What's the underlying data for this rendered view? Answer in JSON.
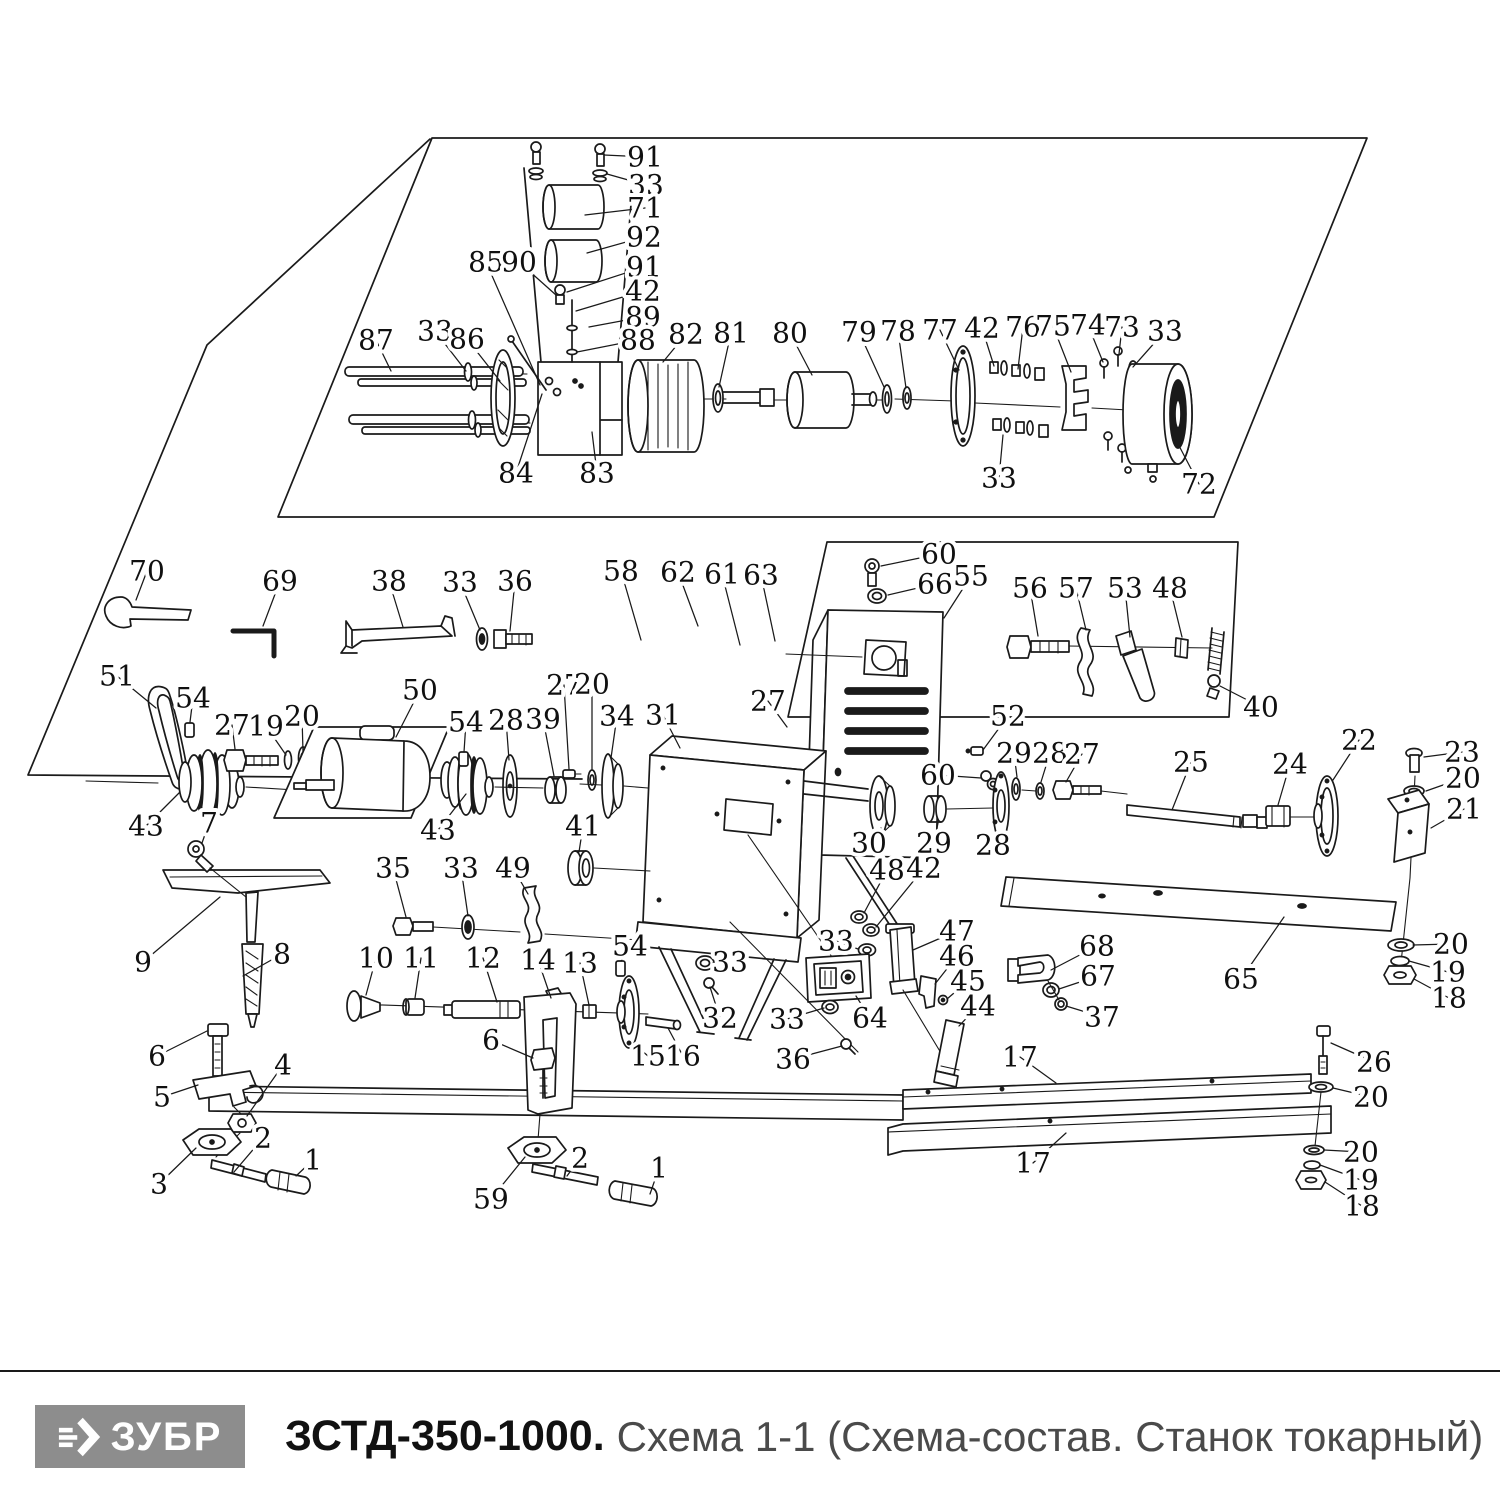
{
  "footer": {
    "logo_text": "ЗУБР",
    "title_model": "ЗСТД-350-1000.",
    "title_rest": "Схема 1-1 (Схема-состав. Станок токарный)",
    "colors": {
      "logo_bg": "#8d8d8d",
      "logo_fg": "#ffffff",
      "title_model_color": "#111111",
      "title_rest_color": "#4a4a4a",
      "rule_color": "#1a1a1a"
    }
  },
  "diagram": {
    "ink": "#1a1a1a",
    "labels": [
      {
        "n": "91",
        "x": 645,
        "y": 157,
        "lx": 604,
        "ly": 155
      },
      {
        "n": "33",
        "x": 646,
        "y": 185,
        "lx": 607,
        "ly": 174
      },
      {
        "n": "71",
        "x": 645,
        "y": 208,
        "lx": 585,
        "ly": 215
      },
      {
        "n": "92",
        "x": 644,
        "y": 237,
        "lx": 587,
        "ly": 253
      },
      {
        "n": "91",
        "x": 644,
        "y": 267,
        "lx": 567,
        "ly": 292
      },
      {
        "n": "42",
        "x": 643,
        "y": 291,
        "lx": 576,
        "ly": 311
      },
      {
        "n": "89",
        "x": 643,
        "y": 317,
        "lx": 589,
        "ly": 327
      },
      {
        "n": "88",
        "x": 638,
        "y": 340,
        "lx": 577,
        "ly": 352
      },
      {
        "n": "85",
        "x": 486,
        "y": 262,
        "lx": 540,
        "ly": 385
      },
      {
        "n": "90",
        "x": 519,
        "y": 262,
        "lx": 556,
        "ly": 295
      },
      {
        "n": "87",
        "x": 376,
        "y": 340,
        "lx": 391,
        "ly": 371
      },
      {
        "n": "33",
        "x": 435,
        "y": 331,
        "lx": 466,
        "ly": 371
      },
      {
        "n": "86",
        "x": 467,
        "y": 339,
        "lx": 500,
        "ly": 381
      },
      {
        "n": "82",
        "x": 686,
        "y": 334,
        "lx": 663,
        "ly": 362
      },
      {
        "n": "81",
        "x": 731,
        "y": 333,
        "lx": 719,
        "ly": 387
      },
      {
        "n": "80",
        "x": 790,
        "y": 333,
        "lx": 812,
        "ly": 375
      },
      {
        "n": "79",
        "x": 859,
        "y": 332,
        "lx": 884,
        "ly": 387
      },
      {
        "n": "78",
        "x": 898,
        "y": 331,
        "lx": 906,
        "ly": 388
      },
      {
        "n": "77",
        "x": 940,
        "y": 330,
        "lx": 959,
        "ly": 370
      },
      {
        "n": "42",
        "x": 982,
        "y": 328,
        "lx": 994,
        "ly": 366
      },
      {
        "n": "76",
        "x": 1023,
        "y": 327,
        "lx": 1018,
        "ly": 369
      },
      {
        "n": "75",
        "x": 1053,
        "y": 326,
        "lx": 1071,
        "ly": 372
      },
      {
        "n": "74",
        "x": 1088,
        "y": 325,
        "lx": 1103,
        "ly": 362
      },
      {
        "n": "73",
        "x": 1122,
        "y": 327,
        "lx": 1119,
        "ly": 354
      },
      {
        "n": "33",
        "x": 1165,
        "y": 331,
        "lx": 1133,
        "ly": 367
      },
      {
        "n": "84",
        "x": 516,
        "y": 473,
        "lx": 542,
        "ly": 394
      },
      {
        "n": "83",
        "x": 597,
        "y": 473,
        "lx": 592,
        "ly": 432
      },
      {
        "n": "33",
        "x": 999,
        "y": 478,
        "lx": 1003,
        "ly": 435
      },
      {
        "n": "72",
        "x": 1199,
        "y": 484,
        "lx": 1176,
        "ly": 440
      },
      {
        "n": "70",
        "x": 147,
        "y": 571,
        "lx": 136,
        "ly": 600
      },
      {
        "n": "69",
        "x": 280,
        "y": 581,
        "lx": 263,
        "ly": 626
      },
      {
        "n": "38",
        "x": 389,
        "y": 581,
        "lx": 403,
        "ly": 627
      },
      {
        "n": "33",
        "x": 460,
        "y": 582,
        "lx": 480,
        "ly": 630
      },
      {
        "n": "36",
        "x": 515,
        "y": 581,
        "lx": 510,
        "ly": 631
      },
      {
        "n": "58",
        "x": 621,
        "y": 571,
        "lx": 641,
        "ly": 640
      },
      {
        "n": "62",
        "x": 678,
        "y": 572,
        "lx": 698,
        "ly": 626
      },
      {
        "n": "61",
        "x": 722,
        "y": 574,
        "lx": 740,
        "ly": 645
      },
      {
        "n": "63",
        "x": 761,
        "y": 575,
        "lx": 775,
        "ly": 641
      },
      {
        "n": "60",
        "x": 939,
        "y": 554,
        "lx": 881,
        "ly": 566
      },
      {
        "n": "66",
        "x": 935,
        "y": 584,
        "lx": 888,
        "ly": 595
      },
      {
        "n": "55",
        "x": 971,
        "y": 576,
        "lx": 944,
        "ly": 618
      },
      {
        "n": "56",
        "x": 1030,
        "y": 588,
        "lx": 1038,
        "ly": 636
      },
      {
        "n": "57",
        "x": 1076,
        "y": 588,
        "lx": 1086,
        "ly": 630
      },
      {
        "n": "53",
        "x": 1125,
        "y": 588,
        "lx": 1130,
        "ly": 637
      },
      {
        "n": "48",
        "x": 1170,
        "y": 588,
        "lx": 1182,
        "ly": 637
      },
      {
        "n": "40",
        "x": 1261,
        "y": 707,
        "lx": 1220,
        "ly": 686
      },
      {
        "n": "51",
        "x": 117,
        "y": 676,
        "lx": 156,
        "ly": 708
      },
      {
        "n": "54",
        "x": 193,
        "y": 698,
        "lx": 190,
        "ly": 722
      },
      {
        "n": "27",
        "x": 232,
        "y": 725,
        "lx": 235,
        "ly": 749
      },
      {
        "n": "19",
        "x": 266,
        "y": 726,
        "lx": 286,
        "ly": 755
      },
      {
        "n": "20",
        "x": 302,
        "y": 716,
        "lx": 303,
        "ly": 752
      },
      {
        "n": "50",
        "x": 420,
        "y": 690,
        "lx": 396,
        "ly": 737
      },
      {
        "n": "54",
        "x": 466,
        "y": 722,
        "lx": 464,
        "ly": 752
      },
      {
        "n": "28",
        "x": 506,
        "y": 720,
        "lx": 509,
        "ly": 760
      },
      {
        "n": "39",
        "x": 543,
        "y": 719,
        "lx": 554,
        "ly": 776
      },
      {
        "n": "27",
        "x": 564,
        "y": 685,
        "lx": 569,
        "ly": 769
      },
      {
        "n": "20",
        "x": 592,
        "y": 684,
        "lx": 592,
        "ly": 769
      },
      {
        "n": "34",
        "x": 617,
        "y": 716,
        "lx": 611,
        "ly": 758
      },
      {
        "n": "31",
        "x": 663,
        "y": 715,
        "lx": 680,
        "ly": 748
      },
      {
        "n": "27",
        "x": 768,
        "y": 701,
        "lx": 787,
        "ly": 727
      },
      {
        "n": "52",
        "x": 1008,
        "y": 716,
        "lx": 983,
        "ly": 750
      },
      {
        "n": "29",
        "x": 1014,
        "y": 753,
        "lx": 1017,
        "ly": 777
      },
      {
        "n": "28",
        "x": 1050,
        "y": 753,
        "lx": 1041,
        "ly": 782
      },
      {
        "n": "27",
        "x": 1082,
        "y": 754,
        "lx": 1066,
        "ly": 782
      },
      {
        "n": "25",
        "x": 1191,
        "y": 762,
        "lx": 1172,
        "ly": 810
      },
      {
        "n": "24",
        "x": 1290,
        "y": 764,
        "lx": 1278,
        "ly": 805
      },
      {
        "n": "22",
        "x": 1359,
        "y": 740,
        "lx": 1333,
        "ly": 780
      },
      {
        "n": "23",
        "x": 1462,
        "y": 752,
        "lx": 1424,
        "ly": 757
      },
      {
        "n": "20",
        "x": 1463,
        "y": 778,
        "lx": 1426,
        "ly": 791
      },
      {
        "n": "21",
        "x": 1464,
        "y": 809,
        "lx": 1431,
        "ly": 828
      },
      {
        "n": "30",
        "x": 869,
        "y": 843,
        "lx": 881,
        "ly": 828
      },
      {
        "n": "29",
        "x": 934,
        "y": 843,
        "lx": 938,
        "ly": 823
      },
      {
        "n": "28",
        "x": 993,
        "y": 845,
        "lx": 1001,
        "ly": 832
      },
      {
        "n": "60",
        "x": 938,
        "y": 775,
        "lx": 981,
        "ly": 778
      },
      {
        "n": "48",
        "x": 887,
        "y": 870,
        "lx": 864,
        "ly": 913
      },
      {
        "n": "42",
        "x": 924,
        "y": 868,
        "lx": 876,
        "ly": 927
      },
      {
        "n": "33",
        "x": 836,
        "y": 941,
        "lx": 858,
        "ly": 949
      },
      {
        "n": "47",
        "x": 957,
        "y": 931,
        "lx": 913,
        "ly": 950
      },
      {
        "n": "46",
        "x": 957,
        "y": 956,
        "lx": 935,
        "ly": 984
      },
      {
        "n": "45",
        "x": 968,
        "y": 981,
        "lx": 947,
        "ly": 999
      },
      {
        "n": "44",
        "x": 978,
        "y": 1006,
        "lx": 959,
        "ly": 1026
      },
      {
        "n": "68",
        "x": 1097,
        "y": 946,
        "lx": 1051,
        "ly": 970
      },
      {
        "n": "67",
        "x": 1098,
        "y": 976,
        "lx": 1059,
        "ly": 989
      },
      {
        "n": "37",
        "x": 1102,
        "y": 1017,
        "lx": 1066,
        "ly": 1006
      },
      {
        "n": "65",
        "x": 1241,
        "y": 979,
        "lx": 1284,
        "ly": 917
      },
      {
        "n": "20",
        "x": 1451,
        "y": 944,
        "lx": 1413,
        "ly": 945
      },
      {
        "n": "19",
        "x": 1448,
        "y": 972,
        "lx": 1409,
        "ly": 961
      },
      {
        "n": "18",
        "x": 1449,
        "y": 998,
        "lx": 1414,
        "ly": 979
      },
      {
        "n": "17",
        "x": 1020,
        "y": 1057,
        "lx": 1056,
        "ly": 1083
      },
      {
        "n": "26",
        "x": 1374,
        "y": 1062,
        "lx": 1331,
        "ly": 1043
      },
      {
        "n": "20",
        "x": 1371,
        "y": 1097,
        "lx": 1333,
        "ly": 1088
      },
      {
        "n": "17",
        "x": 1033,
        "y": 1163,
        "lx": 1066,
        "ly": 1133
      },
      {
        "n": "20",
        "x": 1361,
        "y": 1152,
        "lx": 1324,
        "ly": 1150
      },
      {
        "n": "19",
        "x": 1361,
        "y": 1180,
        "lx": 1320,
        "ly": 1165
      },
      {
        "n": "18",
        "x": 1362,
        "y": 1206,
        "lx": 1325,
        "ly": 1182
      },
      {
        "n": "9",
        "x": 143,
        "y": 962,
        "lx": 220,
        "ly": 897
      },
      {
        "n": "8",
        "x": 282,
        "y": 954,
        "lx": 243,
        "ly": 976
      },
      {
        "n": "35",
        "x": 393,
        "y": 868,
        "lx": 406,
        "ly": 917
      },
      {
        "n": "33",
        "x": 461,
        "y": 868,
        "lx": 468,
        "ly": 916
      },
      {
        "n": "49",
        "x": 513,
        "y": 868,
        "lx": 528,
        "ly": 894
      },
      {
        "n": "10",
        "x": 376,
        "y": 958,
        "lx": 366,
        "ly": 995
      },
      {
        "n": "11",
        "x": 421,
        "y": 958,
        "lx": 415,
        "ly": 998
      },
      {
        "n": "12",
        "x": 483,
        "y": 958,
        "lx": 497,
        "ly": 1002
      },
      {
        "n": "14",
        "x": 538,
        "y": 960,
        "lx": 551,
        "ly": 998
      },
      {
        "n": "13",
        "x": 580,
        "y": 963,
        "lx": 589,
        "ly": 1005
      },
      {
        "n": "54",
        "x": 630,
        "y": 946,
        "lx": 621,
        "ly": 961
      },
      {
        "n": "6",
        "x": 157,
        "y": 1056,
        "lx": 207,
        "ly": 1031
      },
      {
        "n": "5",
        "x": 162,
        "y": 1097,
        "lx": 198,
        "ly": 1085
      },
      {
        "n": "4",
        "x": 283,
        "y": 1065,
        "lx": 247,
        "ly": 1116
      },
      {
        "n": "2",
        "x": 263,
        "y": 1138,
        "lx": 234,
        "ly": 1172
      },
      {
        "n": "1",
        "x": 313,
        "y": 1160,
        "lx": 296,
        "ly": 1176
      },
      {
        "n": "3",
        "x": 159,
        "y": 1184,
        "lx": 196,
        "ly": 1148
      },
      {
        "n": "6",
        "x": 491,
        "y": 1040,
        "lx": 533,
        "ly": 1058
      },
      {
        "n": "59",
        "x": 491,
        "y": 1199,
        "lx": 525,
        "ly": 1157
      },
      {
        "n": "2",
        "x": 580,
        "y": 1158,
        "lx": 567,
        "ly": 1176
      },
      {
        "n": "1",
        "x": 659,
        "y": 1168,
        "lx": 650,
        "ly": 1194
      },
      {
        "n": "15",
        "x": 648,
        "y": 1056,
        "lx": 634,
        "ly": 1044
      },
      {
        "n": "16",
        "x": 683,
        "y": 1056,
        "lx": 668,
        "ly": 1028
      },
      {
        "n": "33",
        "x": 730,
        "y": 962,
        "lx": 713,
        "ly": 963
      },
      {
        "n": "32",
        "x": 720,
        "y": 1018,
        "lx": 710,
        "ly": 987
      },
      {
        "n": "33",
        "x": 787,
        "y": 1019,
        "lx": 824,
        "ly": 1008
      },
      {
        "n": "64",
        "x": 870,
        "y": 1018,
        "lx": 856,
        "ly": 996
      },
      {
        "n": "36",
        "x": 793,
        "y": 1059,
        "lx": 842,
        "ly": 1046
      },
      {
        "n": "7",
        "x": 209,
        "y": 823,
        "lx": 202,
        "ly": 843
      },
      {
        "n": "43",
        "x": 146,
        "y": 826,
        "lx": 180,
        "ly": 792
      },
      {
        "n": "43",
        "x": 438,
        "y": 830,
        "lx": 466,
        "ly": 794
      },
      {
        "n": "41",
        "x": 583,
        "y": 826,
        "lx": 579,
        "ly": 852
      }
    ]
  }
}
